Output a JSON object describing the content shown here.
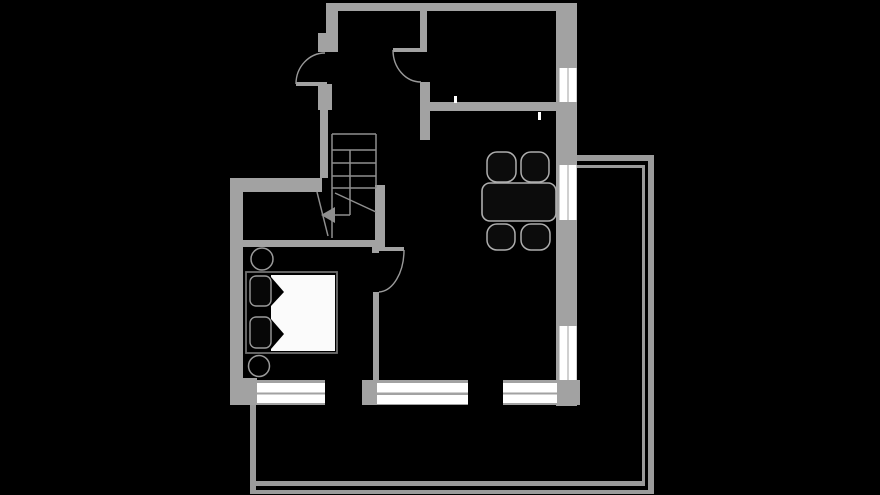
{
  "canvas": {
    "width": 880,
    "height": 495,
    "background": "#000000"
  },
  "palette": {
    "wall": "#a2a2a2",
    "railing": "#9b9b9b",
    "stair_line": "#8f8f8f",
    "door_arc": "#9a9a9a",
    "window_pane": "#ffffff",
    "tick": "#ffffff",
    "furniture_fill": "#0c0c0c",
    "furniture_stroke": "#aeaeae",
    "bed_frame": "#6f6f6f",
    "pillow_stroke": "#9a9a9a",
    "mattress": "#fbfbfb",
    "fold": "#000000"
  },
  "floorplan": {
    "walls": [
      {
        "name": "wall-north",
        "rect": [
          326,
          3,
          251,
          8
        ]
      },
      {
        "name": "wall-west-upper",
        "rect": [
          326,
          3,
          12,
          30
        ]
      },
      {
        "name": "entry-door-stub-upper",
        "rect": [
          318,
          33,
          20,
          19
        ]
      },
      {
        "name": "entry-door-stub-lower",
        "rect": [
          318,
          84,
          14,
          26
        ]
      },
      {
        "name": "hall-west-wall",
        "rect": [
          320,
          110,
          8,
          68
        ]
      },
      {
        "name": "hall-north-wall",
        "rect": [
          230,
          178,
          92,
          14
        ]
      },
      {
        "name": "wall-west-lower",
        "rect": [
          230,
          178,
          13,
          227
        ]
      },
      {
        "name": "hall-south-wall",
        "rect": [
          230,
          240,
          155,
          7
        ]
      },
      {
        "name": "stair-side-wall",
        "rect": [
          375,
          185,
          10,
          62
        ]
      },
      {
        "name": "storage-east-wall",
        "rect": [
          420,
          11,
          7,
          36
        ]
      },
      {
        "name": "kitchen-door-hinge-stub",
        "rect": [
          420,
          47,
          7,
          5
        ]
      },
      {
        "name": "kitchen-west-wall",
        "rect": [
          420,
          82,
          10,
          58
        ]
      },
      {
        "name": "interior-cross-wall",
        "rect": [
          427,
          102,
          129,
          9
        ]
      },
      {
        "name": "wall-east",
        "rect": [
          556,
          3,
          21,
          403
        ]
      },
      {
        "name": "bedroom-door-stub",
        "rect": [
          372,
          247,
          7,
          6
        ]
      },
      {
        "name": "bedroom-partition-wall",
        "rect": [
          373,
          292,
          6,
          88
        ]
      },
      {
        "name": "wall-south-west-block",
        "rect": [
          230,
          378,
          27,
          27
        ]
      },
      {
        "name": "wall-south-mid-block",
        "rect": [
          362,
          380,
          15,
          25
        ]
      },
      {
        "name": "wall-south-east-block",
        "rect": [
          556,
          380,
          24,
          25
        ]
      },
      {
        "name": "south-window-frame-1",
        "rect": [
          257,
          380,
          68,
          25
        ]
      },
      {
        "name": "south-window-frame-2",
        "rect": [
          377,
          380,
          91,
          25
        ]
      },
      {
        "name": "south-window-frame-3",
        "rect": [
          503,
          380,
          54,
          25
        ]
      }
    ],
    "door_leaves": [
      {
        "name": "entry-door-leaf",
        "rect": [
          296,
          82,
          31,
          4
        ]
      },
      {
        "name": "kitchen-door-leaf",
        "rect": [
          393,
          48,
          28,
          4
        ]
      },
      {
        "name": "bedroom-door-leaf",
        "rect": [
          377,
          247,
          27,
          4
        ]
      }
    ],
    "door_arcs": [
      {
        "name": "entry-door-arc",
        "path": "M 296 84 A 29 31 0 0 1 325 53"
      },
      {
        "name": "kitchen-door-arc",
        "path": "M 393 50 A 28 32 0 0 0 421 82"
      },
      {
        "name": "bedroom-door-arc",
        "path": "M 404 250 A 26 42 0 0 1 379 292"
      }
    ],
    "windows": [
      {
        "name": "window-east-upper",
        "panes": [
          [
            559.5,
            68,
            8,
            34
          ],
          [
            568.5,
            68,
            8,
            34
          ]
        ]
      },
      {
        "name": "window-east-middle",
        "panes": [
          [
            559.5,
            165,
            8,
            55
          ],
          [
            568.5,
            165,
            8,
            55
          ]
        ]
      },
      {
        "name": "window-east-lower",
        "panes": [
          [
            559.5,
            326,
            8,
            54
          ],
          [
            568.5,
            326,
            8,
            54
          ]
        ]
      },
      {
        "name": "window-south-1",
        "panes": [
          [
            257,
            383,
            68,
            9.5
          ],
          [
            257,
            394.5,
            68,
            8.5
          ]
        ]
      },
      {
        "name": "window-south-2",
        "panes": [
          [
            377,
            383,
            91,
            9.5
          ],
          [
            377,
            395,
            91,
            9
          ]
        ]
      },
      {
        "name": "window-south-3",
        "panes": [
          [
            503,
            383,
            54,
            9.5
          ],
          [
            503,
            394.5,
            54,
            8.5
          ]
        ]
      }
    ],
    "balcony": [
      {
        "name": "balcony-rail-top-outer",
        "rect": [
          577,
          155,
          77,
          6
        ]
      },
      {
        "name": "balcony-rail-top-inner",
        "rect": [
          577,
          165,
          68,
          3
        ]
      },
      {
        "name": "balcony-rail-right-outer",
        "rect": [
          648,
          155,
          6,
          339
        ]
      },
      {
        "name": "balcony-rail-right-inner",
        "rect": [
          642,
          165,
          3,
          321
        ]
      },
      {
        "name": "balcony-rail-bottom-inner",
        "rect": [
          250,
          481,
          395,
          5
        ]
      },
      {
        "name": "balcony-rail-bottom-outer",
        "rect": [
          250,
          490,
          404,
          4
        ]
      },
      {
        "name": "balcony-rail-left",
        "rect": [
          250,
          405,
          6,
          85
        ]
      }
    ],
    "stairs": {
      "lines": [
        [
          332,
          134,
          376,
          134
        ],
        [
          332,
          134,
          332,
          238
        ],
        [
          376,
          134,
          376,
          188
        ],
        [
          332,
          150,
          376,
          150
        ],
        [
          332,
          163,
          376,
          163
        ],
        [
          332,
          176,
          376,
          176
        ],
        [
          332,
          188,
          376,
          188
        ],
        [
          350,
          150,
          350,
          215
        ],
        [
          350,
          215,
          334,
          215
        ],
        [
          335,
          193,
          376,
          212
        ],
        [
          317,
          192,
          328,
          236
        ]
      ],
      "arrow_head": "321,215 335,207 335,223"
    },
    "ticks": [
      {
        "name": "wall-break-tick-1",
        "rect": [
          454,
          96,
          3,
          7
        ]
      },
      {
        "name": "wall-break-tick-2",
        "rect": [
          538,
          112,
          3,
          8
        ]
      }
    ],
    "furniture": {
      "table": {
        "name": "dining-table",
        "rect": [
          482,
          183,
          74,
          38
        ],
        "radius": 8
      },
      "chairs": [
        {
          "name": "dining-chair-1",
          "rect": [
            487,
            152,
            29,
            30
          ]
        },
        {
          "name": "dining-chair-2",
          "rect": [
            521,
            152,
            28,
            30
          ]
        },
        {
          "name": "dining-chair-3",
          "rect": [
            487,
            224,
            28,
            26
          ]
        },
        {
          "name": "dining-chair-4",
          "rect": [
            521,
            224,
            29,
            26
          ]
        }
      ],
      "bed": {
        "frame": {
          "name": "bed-frame",
          "rect": [
            246,
            272,
            91,
            81
          ]
        },
        "mattress": {
          "name": "bed-mattress",
          "rect": [
            271,
            275,
            64,
            76
          ]
        },
        "folds": [
          {
            "name": "duvet-fold-1",
            "points": "271,277 284,292 271,306"
          },
          {
            "name": "duvet-fold-2",
            "points": "271,319 284,334 271,349"
          }
        ],
        "pillows": [
          {
            "name": "pillow-1",
            "rect": [
              250,
              276,
              21,
              30
            ]
          },
          {
            "name": "pillow-2",
            "rect": [
              250,
              317,
              21,
              31
            ]
          }
        ]
      },
      "side_tables": [
        {
          "name": "bedside-table-1",
          "cx": 262,
          "cy": 259,
          "r": 11
        },
        {
          "name": "bedside-table-2",
          "cx": 259,
          "cy": 366,
          "r": 10.5
        }
      ]
    }
  }
}
